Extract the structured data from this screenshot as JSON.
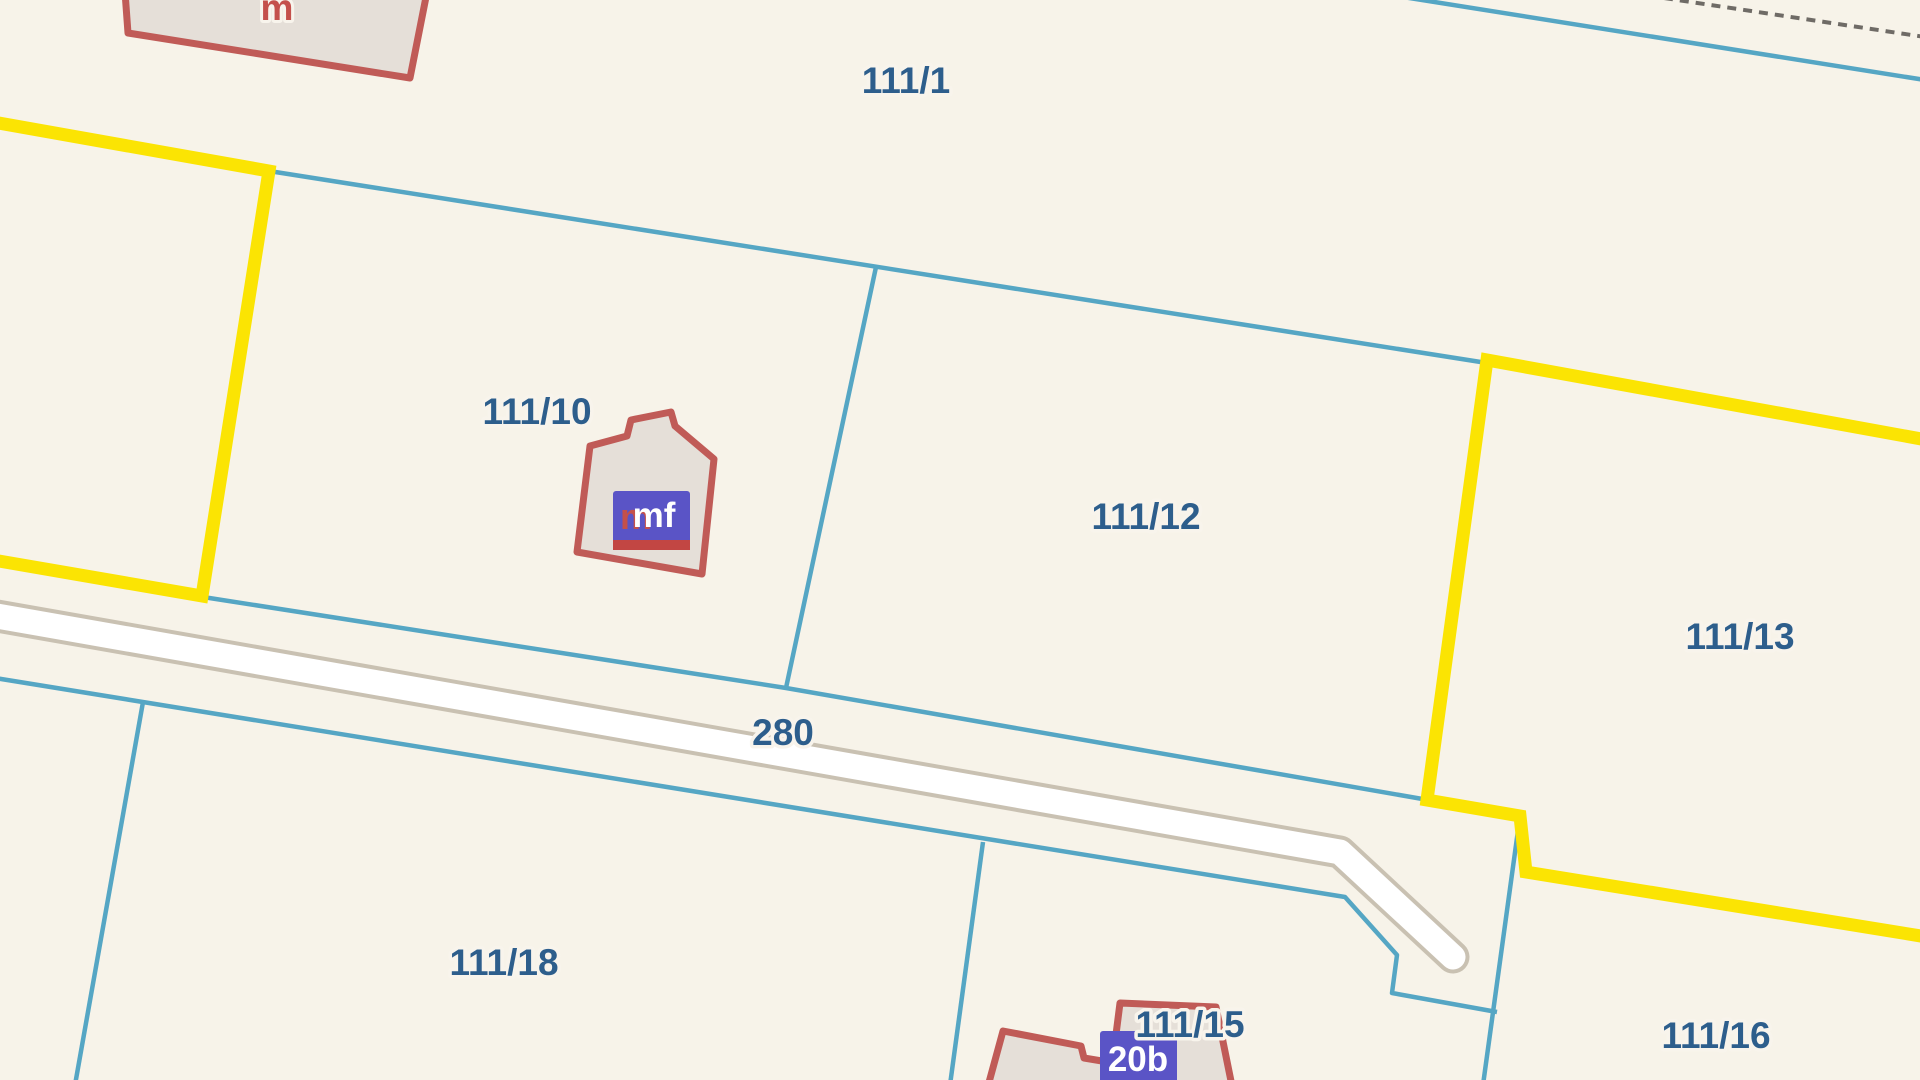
{
  "map": {
    "type": "cadastral-parcel-map",
    "width": 1920,
    "height": 1080,
    "colors": {
      "background": "#f7f3e9",
      "boundary_cyan": "#55a6c4",
      "boundary_selected_yellow": "#fbe403",
      "parcel_label_blue": "#2d5e8c",
      "label_halo": "#f8f4ec",
      "building_fill": "#e5dfd8",
      "building_stroke": "#c05b57",
      "building_label_red": "#c4504b",
      "road_fill": "#ffffff",
      "road_casing": "#c9c1b2",
      "badge_blue": "#5a54c6",
      "badge_stripe_red": "#c24643",
      "dashed_line_gray": "#6f6b66"
    },
    "cyan_lines": [
      {
        "name": "boundary-111-1-south",
        "points": [
          [
            269,
            171
          ],
          [
            1487,
            363
          ]
        ]
      },
      {
        "name": "boundary-111-10-111-12",
        "points": [
          [
            876,
            267
          ],
          [
            786,
            688
          ]
        ]
      },
      {
        "name": "boundary-road-north",
        "points": [
          [
            203,
            597
          ],
          [
            786,
            688
          ],
          [
            1520,
            816
          ]
        ]
      },
      {
        "name": "boundary-road-south",
        "points": [
          [
            -5,
            678
          ],
          [
            1345,
            897
          ],
          [
            1397,
            955
          ],
          [
            1392,
            993
          ],
          [
            1497,
            1012
          ]
        ]
      },
      {
        "name": "boundary-left-parcel-111-18",
        "points": [
          [
            143,
            702
          ],
          [
            75,
            1085
          ]
        ]
      },
      {
        "name": "boundary-111-18-111-15",
        "points": [
          [
            983,
            842
          ],
          [
            950,
            1085
          ]
        ]
      },
      {
        "name": "boundary-111-13-111-16",
        "points": [
          [
            1520,
            816
          ],
          [
            1483,
            1085
          ]
        ]
      },
      {
        "name": "boundary-top-right",
        "points": [
          [
            1403,
            -3
          ],
          [
            1925,
            80
          ]
        ]
      }
    ],
    "dashed_lines": [
      {
        "name": "boundary-dashed-top-right",
        "points": [
          [
            1664,
            -2
          ],
          [
            1925,
            37
          ]
        ],
        "dash": "9 7"
      }
    ],
    "yellow_lines": [
      {
        "name": "selected-boundary-left",
        "points": [
          [
            -7,
            122
          ],
          [
            269,
            171
          ],
          [
            202,
            596
          ],
          [
            -7,
            560
          ]
        ]
      },
      {
        "name": "selected-boundary-111-13",
        "points": [
          [
            1927,
            440
          ],
          [
            1487,
            360
          ],
          [
            1427,
            800
          ],
          [
            1520,
            816
          ],
          [
            1526,
            872
          ],
          [
            1927,
            937
          ]
        ]
      }
    ],
    "road": {
      "name": "road-280",
      "points": [
        [
          -20,
          613
        ],
        [
          1340,
          852
        ],
        [
          1453,
          957
        ]
      ],
      "casing_width": 33,
      "fill_width": 25
    },
    "buildings": [
      {
        "name": "building-top-left",
        "points": [
          [
            125,
            -8
          ],
          [
            128,
            33
          ],
          [
            410,
            78
          ],
          [
            427,
            -8
          ]
        ]
      },
      {
        "name": "building-111-10",
        "points": [
          [
            577,
            552
          ],
          [
            590,
            446
          ],
          [
            627,
            436
          ],
          [
            631,
            420
          ],
          [
            671,
            412
          ],
          [
            675,
            426
          ],
          [
            714,
            459
          ],
          [
            702,
            574
          ]
        ]
      },
      {
        "name": "building-111-15",
        "points": [
          [
            988,
            1086
          ],
          [
            1003,
            1031
          ],
          [
            1081,
            1046
          ],
          [
            1084,
            1058
          ],
          [
            1102,
            1061
          ],
          [
            1113,
            1058
          ],
          [
            1120,
            1003
          ],
          [
            1216,
            1007
          ],
          [
            1232,
            1086
          ]
        ]
      }
    ],
    "badges": [
      {
        "name": "building-badge-mf",
        "rect": [
          613,
          491,
          77,
          59
        ],
        "rx": 3,
        "stripe": [
          613,
          540,
          77,
          10
        ],
        "sub_label": {
          "text": "m",
          "x": 636,
          "y": 529,
          "size": 36
        },
        "label": {
          "text": "mf",
          "x": 654,
          "y": 527,
          "size": 35
        }
      },
      {
        "name": "building-badge-20b",
        "rect": [
          1100,
          1031,
          77,
          60
        ],
        "rx": 3,
        "label": {
          "text": "20b",
          "x": 1138,
          "y": 1071,
          "size": 35
        }
      }
    ],
    "red_labels": [
      {
        "name": "building-label-m",
        "text": "m",
        "x": 277,
        "y": 20,
        "size": 37
      }
    ],
    "parcel_labels": [
      {
        "name": "parcel-label-111-1",
        "text": "111/1",
        "x": 906,
        "y": 93
      },
      {
        "name": "parcel-label-111-10",
        "text": "111/10",
        "x": 537,
        "y": 424
      },
      {
        "name": "parcel-label-111-12",
        "text": "111/12",
        "x": 1146,
        "y": 529
      },
      {
        "name": "parcel-label-111-13",
        "text": "111/13",
        "x": 1740,
        "y": 649
      },
      {
        "name": "road-label-280",
        "text": "280",
        "x": 783,
        "y": 745
      },
      {
        "name": "parcel-label-111-18",
        "text": "111/18",
        "x": 504,
        "y": 975
      },
      {
        "name": "parcel-label-111-15",
        "text": "111/15",
        "x": 1190,
        "y": 1037
      },
      {
        "name": "parcel-label-111-16",
        "text": "111/16",
        "x": 1716,
        "y": 1048
      }
    ],
    "label_font_size": 37
  }
}
